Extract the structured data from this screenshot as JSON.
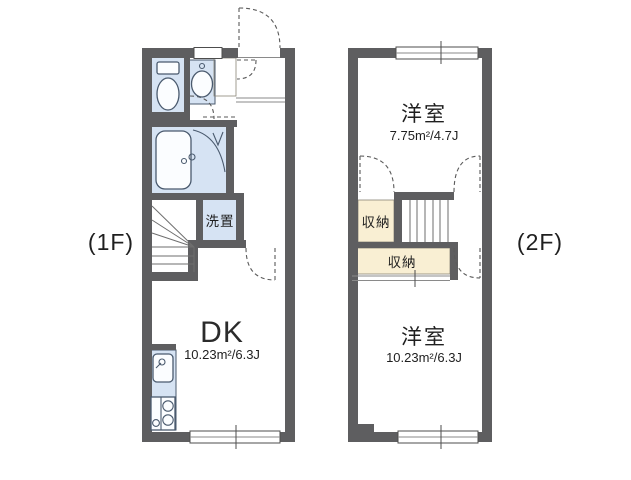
{
  "colors": {
    "wall": "#5e5e60",
    "wet_area": "#d6e3f3",
    "closet": "#f9efd3",
    "fixture_outline": "#4a5a6e",
    "text": "#1f1f1f"
  },
  "floor_1": {
    "label": "(1F)",
    "rooms": {
      "dk": {
        "name": "DK",
        "area": "10.23m²/6.3J"
      },
      "laundry": {
        "name": "洗置"
      }
    }
  },
  "floor_2": {
    "label": "(2F)",
    "rooms": {
      "bedroom_upper": {
        "name": "洋室",
        "area": "7.75m²/4.7J"
      },
      "closet_upper": {
        "name": "収納"
      },
      "closet_lower": {
        "name": "収納"
      },
      "bedroom_lower": {
        "name": "洋室",
        "area": "10.23m²/6.3J"
      }
    }
  }
}
